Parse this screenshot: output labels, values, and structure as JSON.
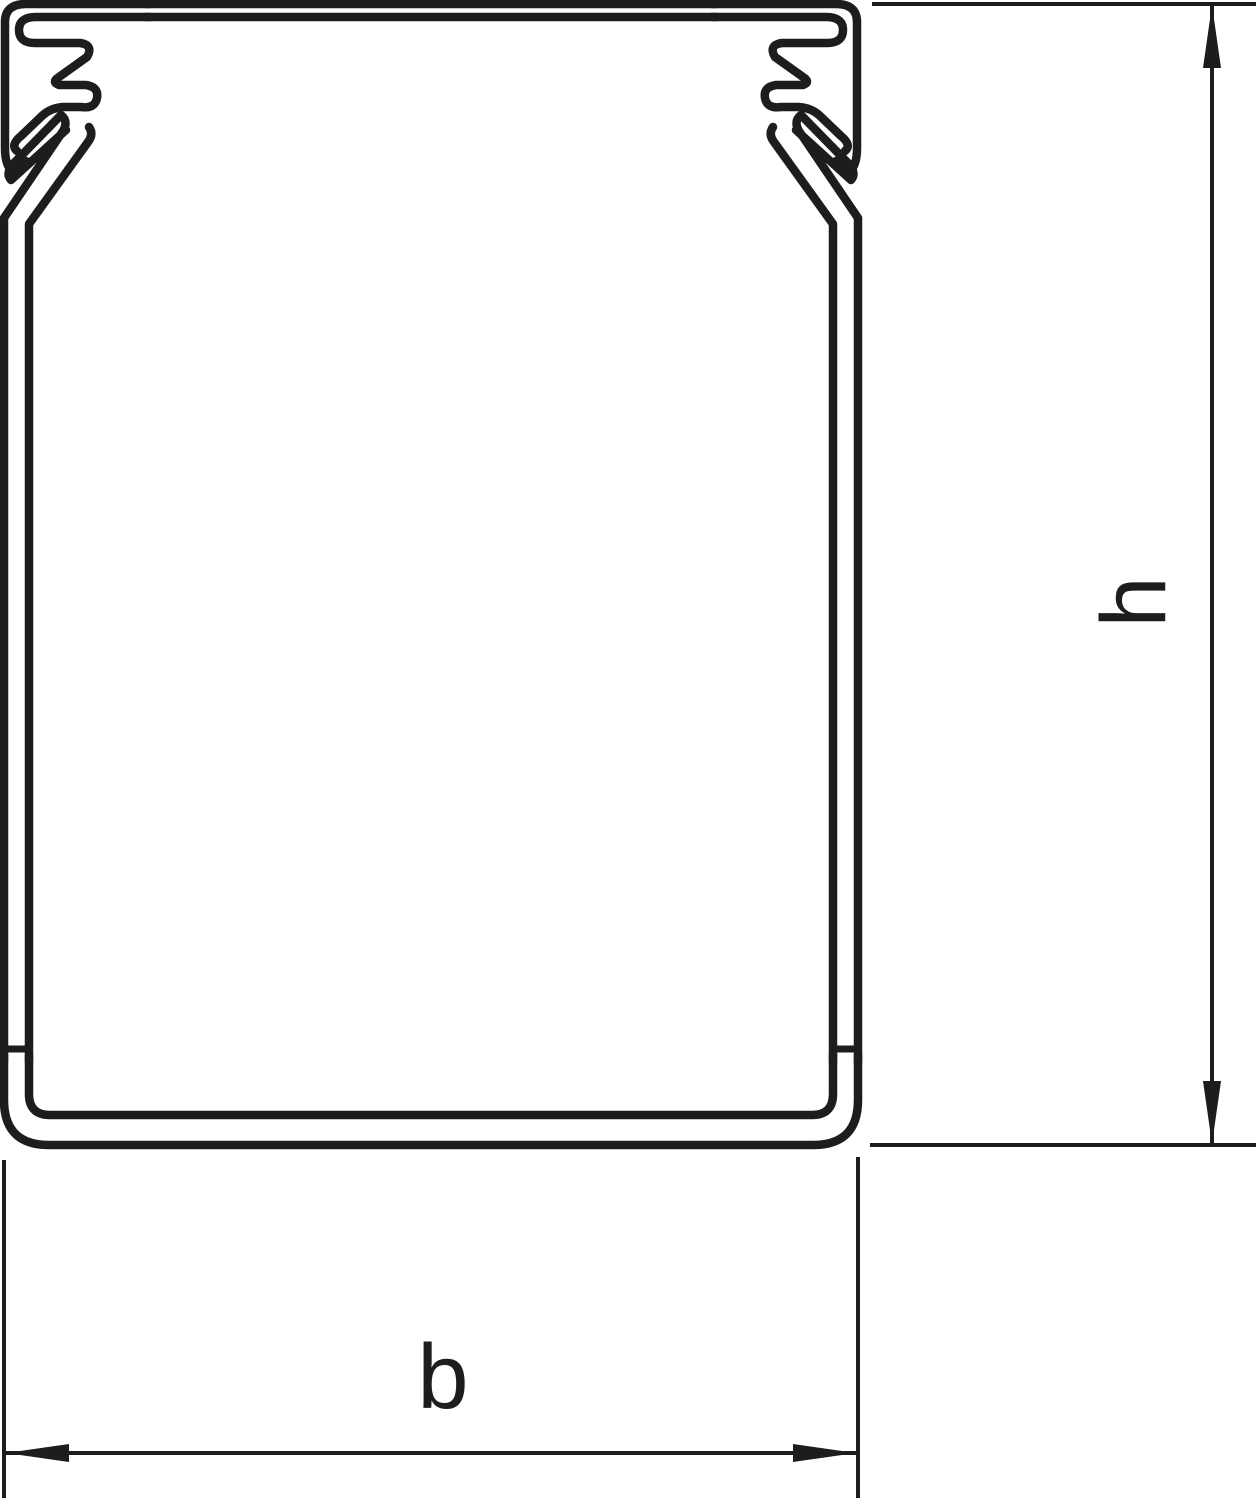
{
  "diagram": {
    "type": "technical-cross-section",
    "subject": "cable trunking / wiring duct profile with clip-on cover",
    "line_color": "#1d1d1b",
    "background_color": "#ffffff",
    "dimensions": {
      "height": {
        "label": "h",
        "orientation": "vertical",
        "position": "right"
      },
      "width": {
        "label": "b",
        "orientation": "horizontal",
        "position": "bottom"
      }
    }
  }
}
